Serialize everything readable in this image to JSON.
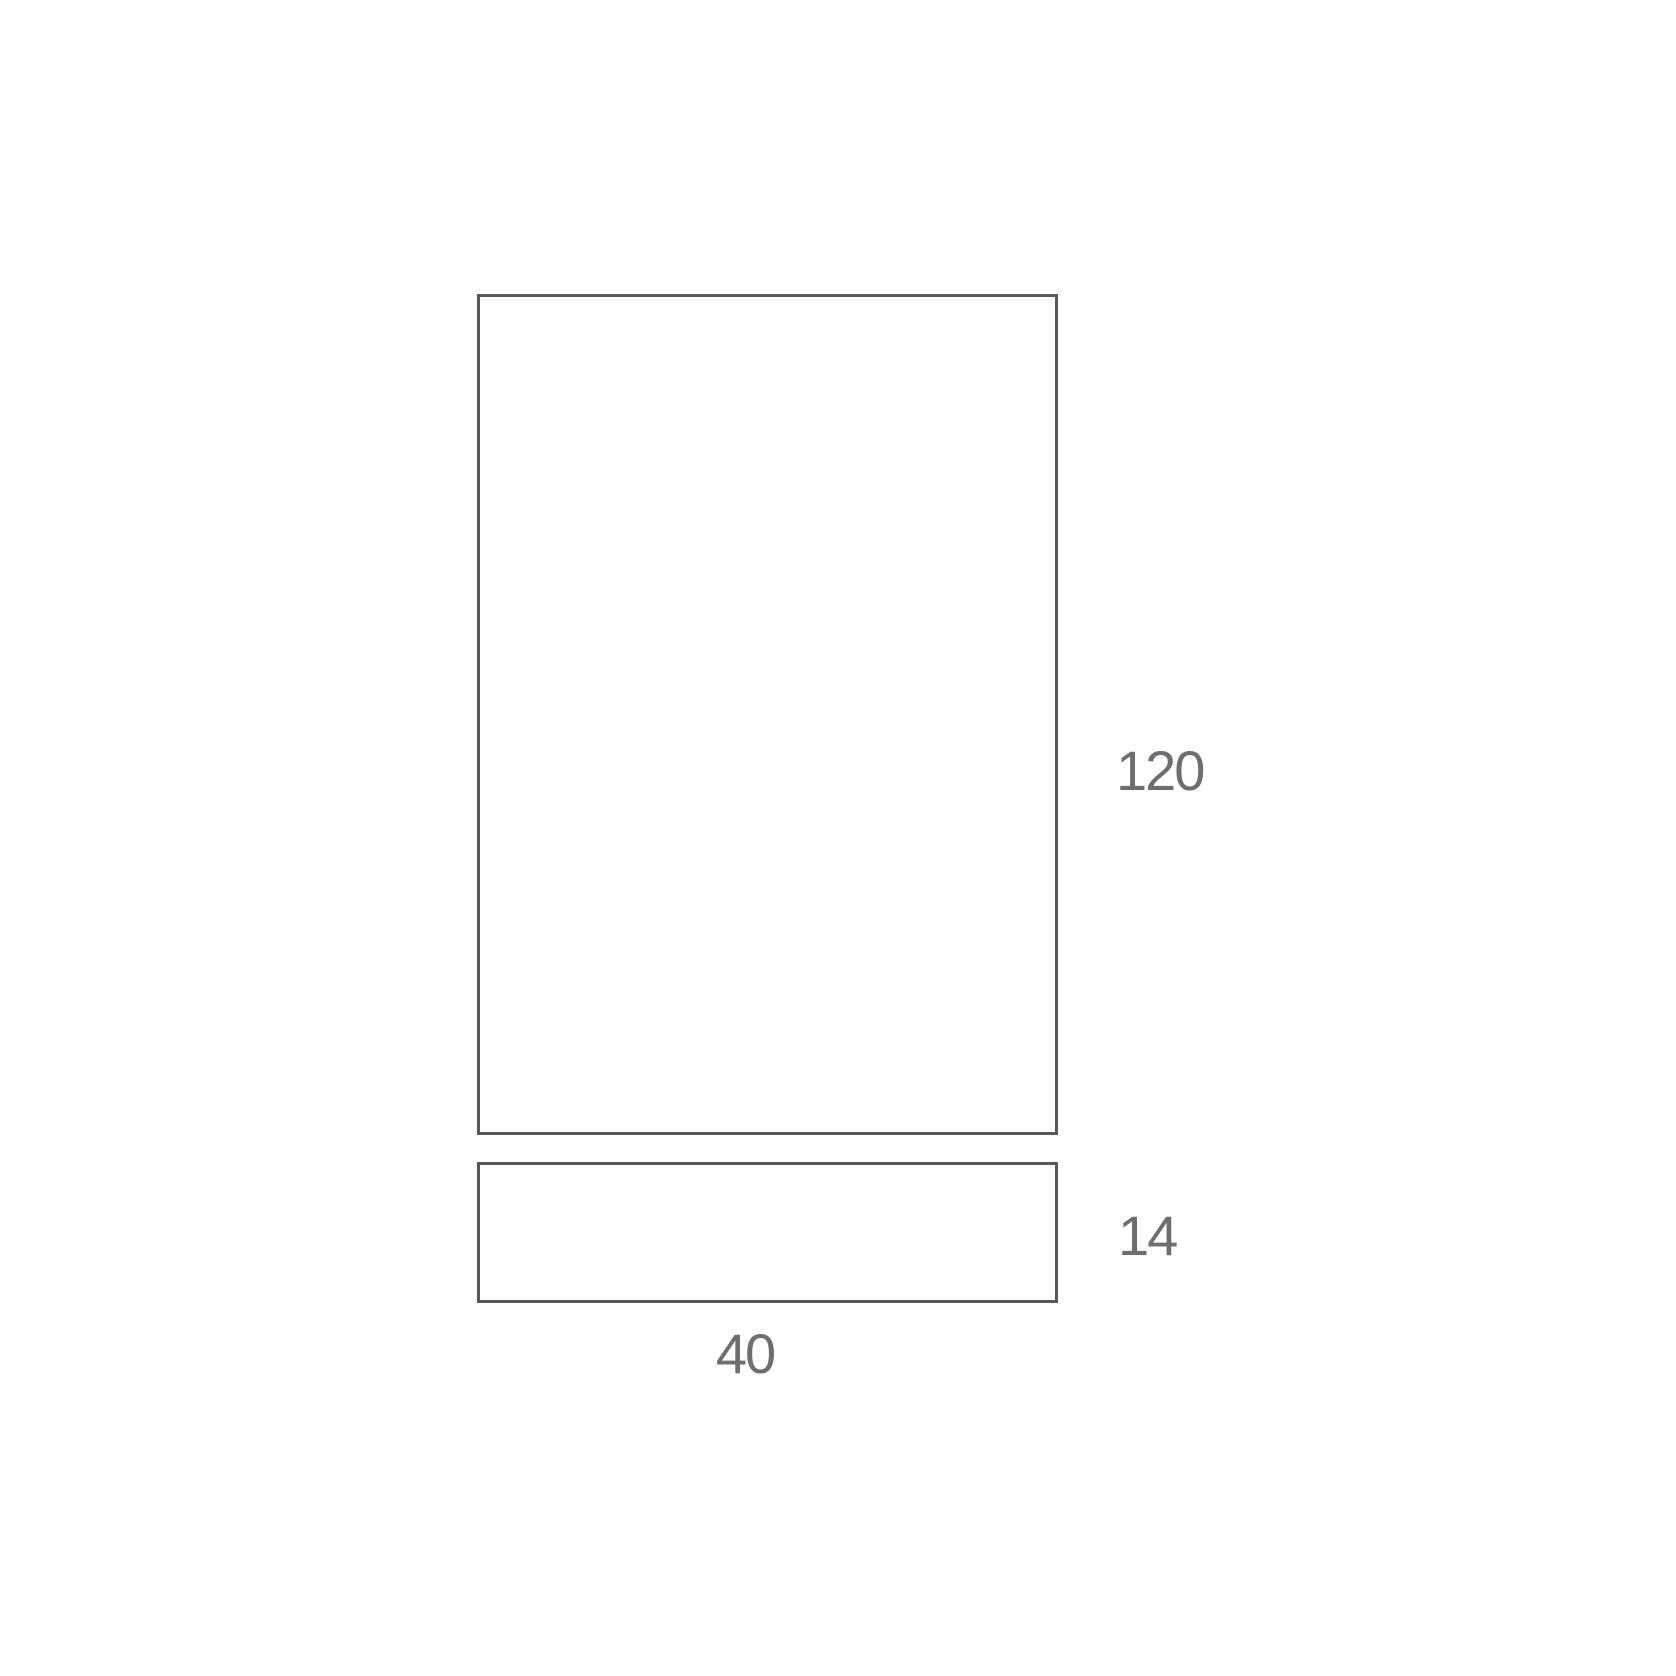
{
  "diagram": {
    "type": "product-dimension-drawing",
    "shapes": [
      {
        "name": "main-panel",
        "kind": "rectangle-outline"
      },
      {
        "name": "base-panel",
        "kind": "rectangle-outline"
      }
    ],
    "dimensions": {
      "height_label": "120",
      "base_height_label": "14",
      "width_label": "40"
    },
    "colors": {
      "line": "#58595b",
      "label": "#6d6e71",
      "background": "#ffffff"
    }
  }
}
